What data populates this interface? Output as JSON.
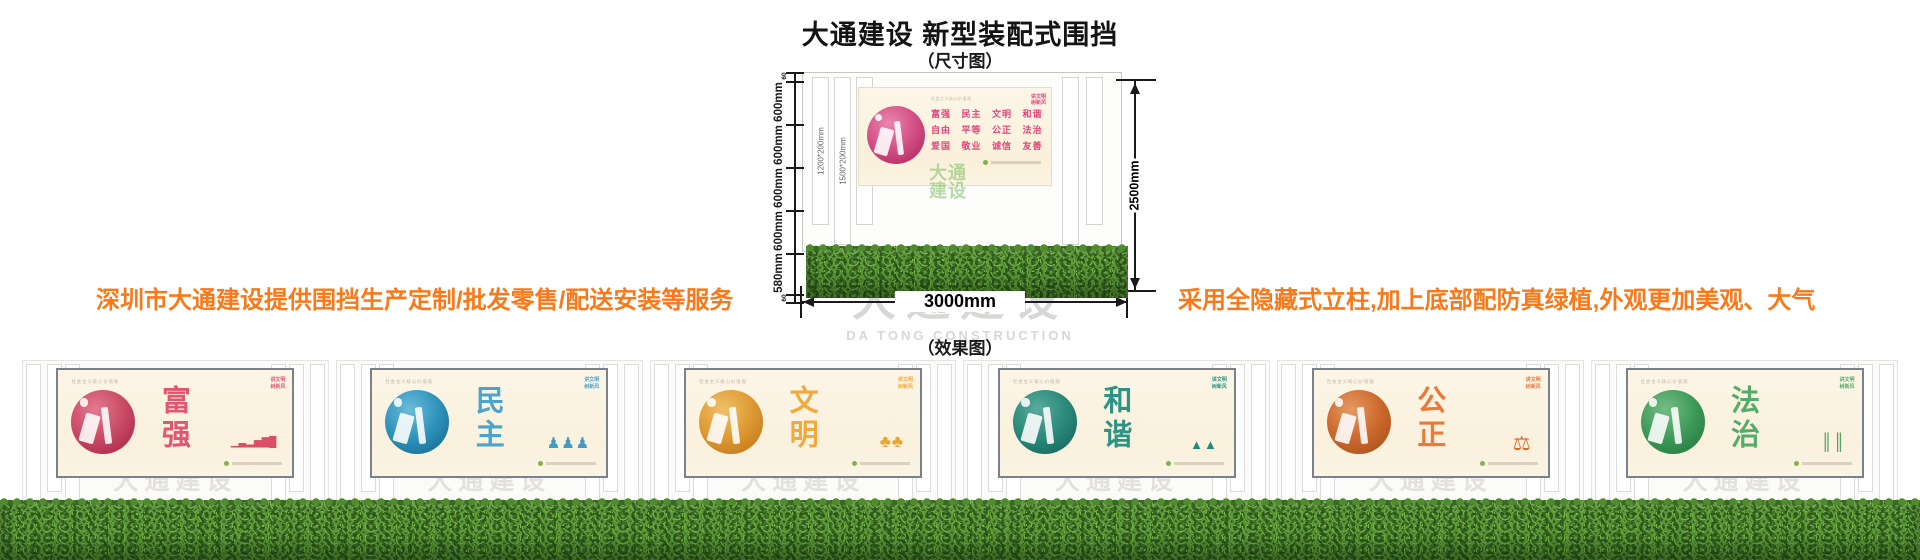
{
  "header": {
    "title": "大通建设 新型装配式围挡",
    "dim_caption": "（尺寸图）",
    "effect_caption": "（效果图）"
  },
  "promos": {
    "left": "深圳市大通建设提供围挡生产定制/批发零售/配送安装等服务",
    "right": "采用全隐藏式立柱,加上底部配防真绿植,外观更加美观、大气",
    "color": "#f8791a"
  },
  "diagram": {
    "left_dims": [
      "60",
      "600mm",
      "600mm",
      "600mm",
      "600mm",
      "580mm",
      "60"
    ],
    "slat_sizes": [
      "1200*200mm",
      "1500*200mm",
      "1200*200mm"
    ],
    "height_dim": "2500mm",
    "width_dim": "3000mm",
    "watermark_cn": "大通建设",
    "watermark_en": "DA TONG CONSTRUCTION"
  },
  "poster_common": {
    "caption": "社会主义核心价值观",
    "badge_line1": "讲文明",
    "badge_line2": "树新风",
    "values_rows": [
      "富强 民主 文明 和谐",
      "自由 平等 公正 法治",
      "爱国 敬业 诚信 友善"
    ],
    "green_logo": "大通建设"
  },
  "diagram_poster": {
    "row_color": "#e0457b",
    "circle_light": "#ea86ad",
    "circle_mid": "#d34f83",
    "circle_dark": "#a8215c"
  },
  "panels": [
    {
      "word": "富强",
      "circle_light": "#e4798f",
      "circle_mid": "#c94b66",
      "circle_dark": "#a21f3f",
      "word_color": "#e25672",
      "motif": "▁▃▂▅▇█",
      "motif_color": "#d94f63"
    },
    {
      "word": "民主",
      "circle_light": "#6cbcd9",
      "circle_mid": "#2f93bc",
      "circle_dark": "#116287",
      "word_color": "#4ba4cf",
      "motif": "♟♟♟",
      "motif_color": "#3f9cc6"
    },
    {
      "word": "文明",
      "circle_light": "#f0c06a",
      "circle_mid": "#dd9a33",
      "circle_dark": "#b96f14",
      "word_color": "#f2a93b",
      "motif": "♣♣",
      "motif_color": "#eda42e"
    },
    {
      "word": "和谐",
      "circle_light": "#5aab9d",
      "circle_mid": "#2a8a7b",
      "circle_dark": "#0f5f54",
      "word_color": "#2d9384",
      "motif": "▲▲",
      "motif_color": "#1f8a7a"
    },
    {
      "word": "公正",
      "circle_light": "#e59a61",
      "circle_mid": "#cc6a2e",
      "circle_dark": "#a34a15",
      "word_color": "#e87a3a",
      "motif": "⚖",
      "motif_color": "#d96a2e"
    },
    {
      "word": "法治",
      "circle_light": "#74bd85",
      "circle_mid": "#3f9b58",
      "circle_dark": "#1d703a",
      "word_color": "#54ac68",
      "motif": "║║",
      "motif_color": "#3f9e55"
    }
  ]
}
